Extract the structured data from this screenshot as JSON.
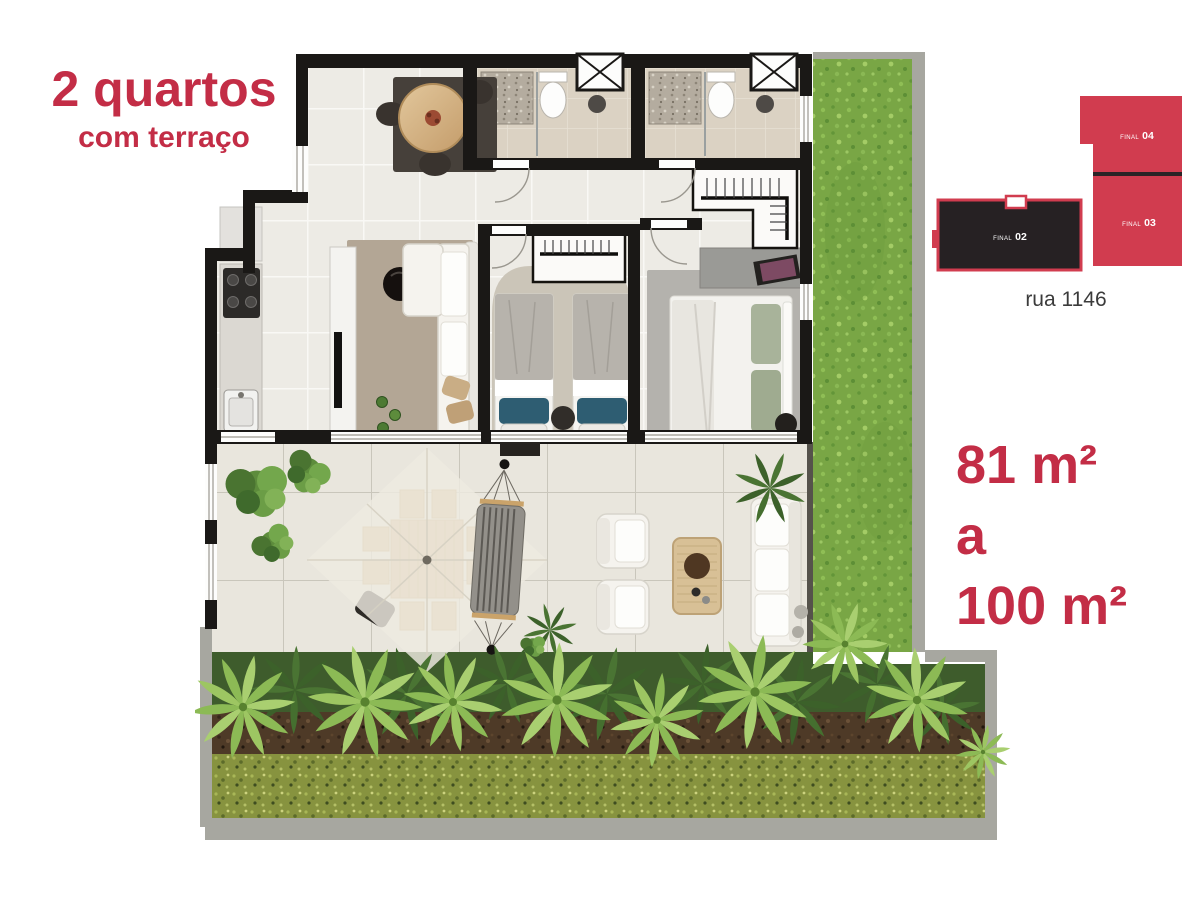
{
  "title": {
    "line1": "2 quartos",
    "line2": "com terraço"
  },
  "area_range": {
    "min": "81 m²",
    "connector": "a",
    "max": "100 m²"
  },
  "key_plan": {
    "street": "rua 1146",
    "units": [
      {
        "prefix": "FINAL",
        "number": "04",
        "highlighted": false
      },
      {
        "prefix": "FINAL",
        "number": "03",
        "highlighted": false
      },
      {
        "prefix": "FINAL",
        "number": "02",
        "highlighted": true
      }
    ]
  },
  "colors": {
    "accent_red": "#c32d46",
    "key_plan_red": "#d13c4f",
    "key_plan_dark": "#262123",
    "wall_black": "#1a1816",
    "grass_green": "#79a645"
  }
}
